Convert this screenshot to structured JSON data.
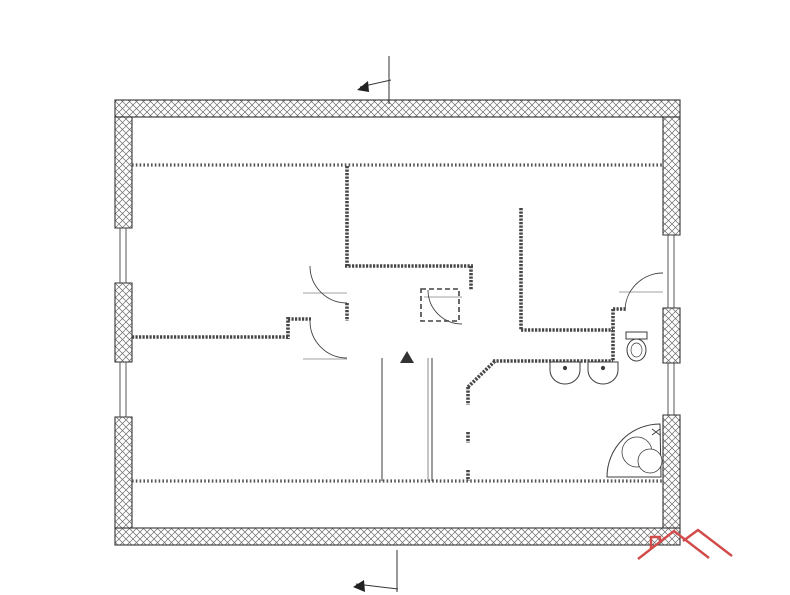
{
  "watermark": {
    "brand": "AZET",
    "subtitle": "Reality"
  },
  "logo": {
    "part1": "Real",
    "part2": "Bonus",
    "part3": ".cz"
  },
  "section_markers": {
    "top": "A'",
    "bottom": "A"
  },
  "room_numbers": [
    {
      "t": "1",
      "x": 236,
      "y": 255
    },
    {
      "t": "2",
      "x": 236,
      "y": 414
    },
    {
      "t": "3",
      "x": 554,
      "y": 265
    },
    {
      "t": "4",
      "x": 452,
      "y": 383
    },
    {
      "t": "5",
      "x": 571,
      "y": 423
    }
  ],
  "dim_labels": [
    {
      "t": "12420",
      "x": 390,
      "y": 27
    },
    {
      "t": "11680",
      "x": 390,
      "y": 45
    },
    {
      "t": "370",
      "x": 126,
      "y": 42
    },
    {
      "t": "370",
      "x": 668,
      "y": 39
    },
    {
      "t": "9720",
      "x": 30,
      "y": 332,
      "r": 1
    },
    {
      "t": "1720",
      "x": 51,
      "y": 332,
      "r": 1
    },
    {
      "t": "2800",
      "x": 80,
      "y": 173,
      "r": 1
    },
    {
      "t": "1200",
      "x": 80,
      "y": 257,
      "r": 1
    },
    {
      "t": "(1500/800)",
      "x": 92,
      "y": 257,
      "r": 1,
      "fs": 6
    },
    {
      "t": "1200",
      "x": 80,
      "y": 391,
      "r": 1
    },
    {
      "t": "(1500/800)",
      "x": 92,
      "y": 391,
      "r": 1,
      "fs": 6
    },
    {
      "t": "2800",
      "x": 80,
      "y": 482,
      "r": 1
    },
    {
      "t": "370",
      "x": 727,
      "y": 111,
      "r": 1,
      "fs": 6
    },
    {
      "t": "2800",
      "x": 700,
      "y": 172,
      "r": 1
    },
    {
      "t": "900",
      "x": 700,
      "y": 251,
      "r": 1
    },
    {
      "t": "(1500/800)",
      "x": 713,
      "y": 253,
      "r": 1,
      "fs": 6
    },
    {
      "t": "900",
      "x": 700,
      "y": 293,
      "r": 1
    },
    {
      "t": "1120",
      "x": 700,
      "y": 333,
      "r": 1
    },
    {
      "t": "1200",
      "x": 700,
      "y": 396,
      "r": 1
    },
    {
      "t": "(1500/800)",
      "x": 713,
      "y": 398,
      "r": 1,
      "fs": 6
    },
    {
      "t": "2800",
      "x": 700,
      "y": 481,
      "r": 1
    },
    {
      "t": "370",
      "x": 727,
      "y": 531,
      "r": 1,
      "fs": 6
    },
    {
      "t": "8980",
      "x": 727,
      "y": 331,
      "r": 1
    },
    {
      "t": "9720",
      "x": 751,
      "y": 331,
      "r": 1
    },
    {
      "t": "1000",
      "x": 147,
      "y": 141,
      "r": 1
    },
    {
      "t": "50",
      "x": 159,
      "y": 161,
      "r": 1,
      "fs": 6
    },
    {
      "t": "1380",
      "x": 140,
      "y": 186,
      "r": 1
    },
    {
      "t": "3625",
      "x": 167,
      "y": 257,
      "r": 1
    },
    {
      "t": "1045",
      "x": 148,
      "y": 307,
      "r": 1
    },
    {
      "t": "75",
      "x": 162,
      "y": 332,
      "r": 1,
      "fs": 6
    },
    {
      "t": "75",
      "x": 180,
      "y": 332,
      "r": 1,
      "fs": 6
    },
    {
      "t": "600",
      "x": 149,
      "y": 353,
      "r": 1
    },
    {
      "t": "3180",
      "x": 167,
      "y": 403,
      "r": 1
    },
    {
      "t": "1380",
      "x": 148,
      "y": 462,
      "r": 1
    },
    {
      "t": "50",
      "x": 161,
      "y": 478,
      "r": 1,
      "fs": 6
    },
    {
      "t": "1000",
      "x": 149,
      "y": 508,
      "r": 1
    },
    {
      "t": "4670",
      "x": 234,
      "y": 203
    },
    {
      "t": "75",
      "x": 357,
      "y": 202,
      "fs": 6
    },
    {
      "t": "6935",
      "x": 488,
      "y": 200
    },
    {
      "t": "2130",
      "x": 517,
      "y": 192,
      "r": 1
    },
    {
      "t": "2730",
      "x": 409,
      "y": 218
    },
    {
      "t": "75",
      "x": 463,
      "y": 218,
      "fs": 6
    },
    {
      "t": "515",
      "x": 486,
      "y": 218
    },
    {
      "t": "75",
      "x": 507,
      "y": 218,
      "fs": 6
    },
    {
      "t": "2500",
      "x": 553,
      "y": 218
    },
    {
      "t": "100",
      "x": 600,
      "y": 218,
      "fs": 6
    },
    {
      "t": "940",
      "x": 630,
      "y": 218
    },
    {
      "t": "1380",
      "x": 627,
      "y": 194,
      "r": 1
    },
    {
      "t": "3470",
      "x": 583,
      "y": 253,
      "r": 1
    },
    {
      "t": "75",
      "x": 516,
      "y": 263,
      "r": 1,
      "fs": 6
    },
    {
      "t": "1265",
      "x": 517,
      "y": 295,
      "r": 1
    },
    {
      "t": "75",
      "x": 516,
      "y": 321,
      "r": 1,
      "fs": 6
    },
    {
      "t": "635",
      "x": 521,
      "y": 340,
      "r": 1
    },
    {
      "t": "100",
      "x": 524,
      "y": 371,
      "r": 1,
      "fs": 6
    },
    {
      "t": "100",
      "x": 582,
      "y": 318,
      "r": 1,
      "fs": 6
    },
    {
      "t": "610",
      "x": 582,
      "y": 341,
      "r": 1
    },
    {
      "t": "100",
      "x": 621,
      "y": 321,
      "r": 1,
      "fs": 6
    },
    {
      "t": "290",
      "x": 629,
      "y": 322,
      "r": 1,
      "fs": 6
    },
    {
      "t": "800",
      "x": 331,
      "y": 289,
      "fs": 6.5
    },
    {
      "t": "1970",
      "x": 333,
      "y": 300
    },
    {
      "t": "800",
      "x": 333,
      "y": 355,
      "fs": 6.5
    },
    {
      "t": "1970",
      "x": 335,
      "y": 366
    },
    {
      "t": "800",
      "x": 457,
      "y": 293,
      "fs": 6.5
    },
    {
      "t": "1970",
      "x": 459,
      "y": 304
    },
    {
      "t": "800",
      "x": 646,
      "y": 289,
      "fs": 6.5
    },
    {
      "t": "1970",
      "x": 649,
      "y": 300
    },
    {
      "t": "450",
      "x": 378,
      "y": 284,
      "r": 1
    },
    {
      "t": "700",
      "x": 378,
      "y": 313,
      "r": 1
    },
    {
      "t": "820",
      "x": 377,
      "y": 343,
      "r": 1
    },
    {
      "t": "900",
      "x": 438,
      "y": 347
    },
    {
      "t": "250",
      "x": 466,
      "y": 357,
      "fs": 6
    },
    {
      "t": "3415",
      "x": 205,
      "y": 318
    },
    {
      "t": "75",
      "x": 281,
      "y": 314,
      "fs": 6
    },
    {
      "t": "1180",
      "x": 318,
      "y": 386
    },
    {
      "t": "770",
      "x": 363,
      "y": 386
    },
    {
      "t": "5440",
      "x": 250,
      "y": 444
    },
    {
      "t": "75",
      "x": 367,
      "y": 456,
      "fs": 6
    },
    {
      "t": "1130",
      "x": 396,
      "y": 442
    },
    {
      "t": "710",
      "x": 450,
      "y": 441
    },
    {
      "t": "75",
      "x": 477,
      "y": 443,
      "fs": 6
    },
    {
      "t": "4250",
      "x": 566,
      "y": 441
    },
    {
      "t": "2575",
      "x": 520,
      "y": 421,
      "r": 1
    },
    {
      "t": "250",
      "x": 497,
      "y": 399,
      "r": 1,
      "fs": 6
    },
    {
      "t": "600",
      "x": 497,
      "y": 418,
      "r": 1
    },
    {
      "t": "250",
      "x": 497,
      "y": 437,
      "r": 1,
      "fs": 6
    },
    {
      "t": "600",
      "x": 497,
      "y": 456,
      "r": 1
    },
    {
      "t": "210",
      "x": 497,
      "y": 475,
      "r": 1,
      "fs": 6
    },
    {
      "t": "1.55",
      "x": 633,
      "y": 438,
      "r": 1,
      "fs": 6
    }
  ]
}
